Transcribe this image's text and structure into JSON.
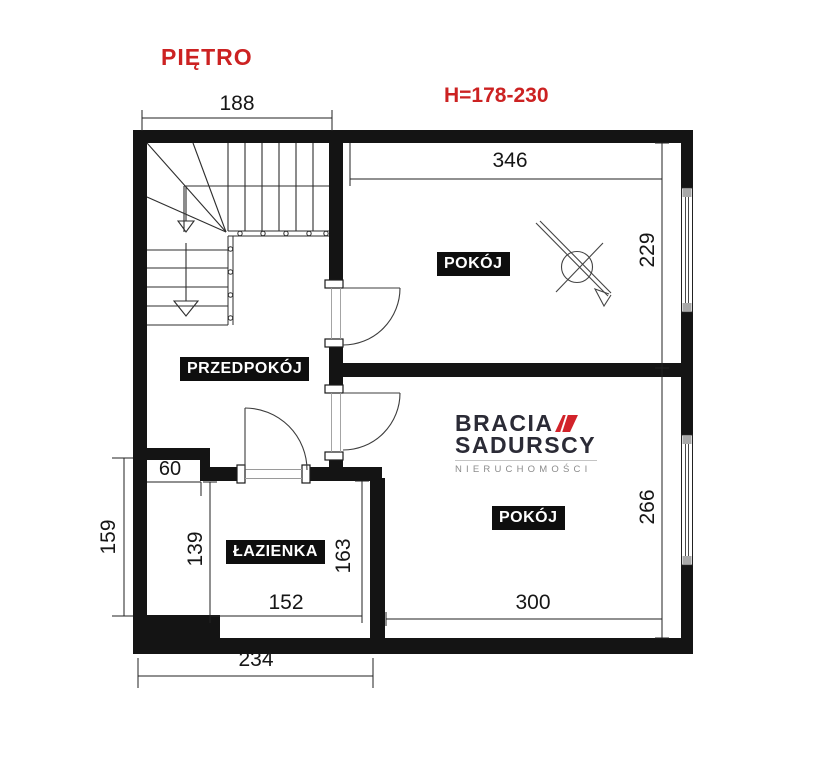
{
  "plan": {
    "floor_title": "PIĘTRO",
    "ceiling_height": "H=178-230"
  },
  "rooms": {
    "room_top": "POKÓJ",
    "room_bottom": "POKÓJ",
    "hallway": "PRZEDPOKÓJ",
    "bathroom": "ŁAZIENKA"
  },
  "dimensions_cm": {
    "stairs_width": "188",
    "room_top_width": "346",
    "room_top_depth": "229",
    "room_bottom_depth": "266",
    "room_bottom_width": "300",
    "bathroom_width": "152",
    "bottom_left_width": "234",
    "niche_width": "60",
    "niche_depth": "139",
    "left_depth": "159",
    "bathroom_depth": "163"
  },
  "watermark": {
    "brand_line1": "BRACIA",
    "brand_line2": "SADURSCY",
    "brand_line3": "NIERUCHOMOŚCI"
  },
  "colors": {
    "annotation_red": "#cc2222",
    "wall_black": "#141414",
    "logo_navy": "#2b2b36",
    "logo_red": "#d2232a",
    "logo_gray": "#8c8c8c"
  }
}
